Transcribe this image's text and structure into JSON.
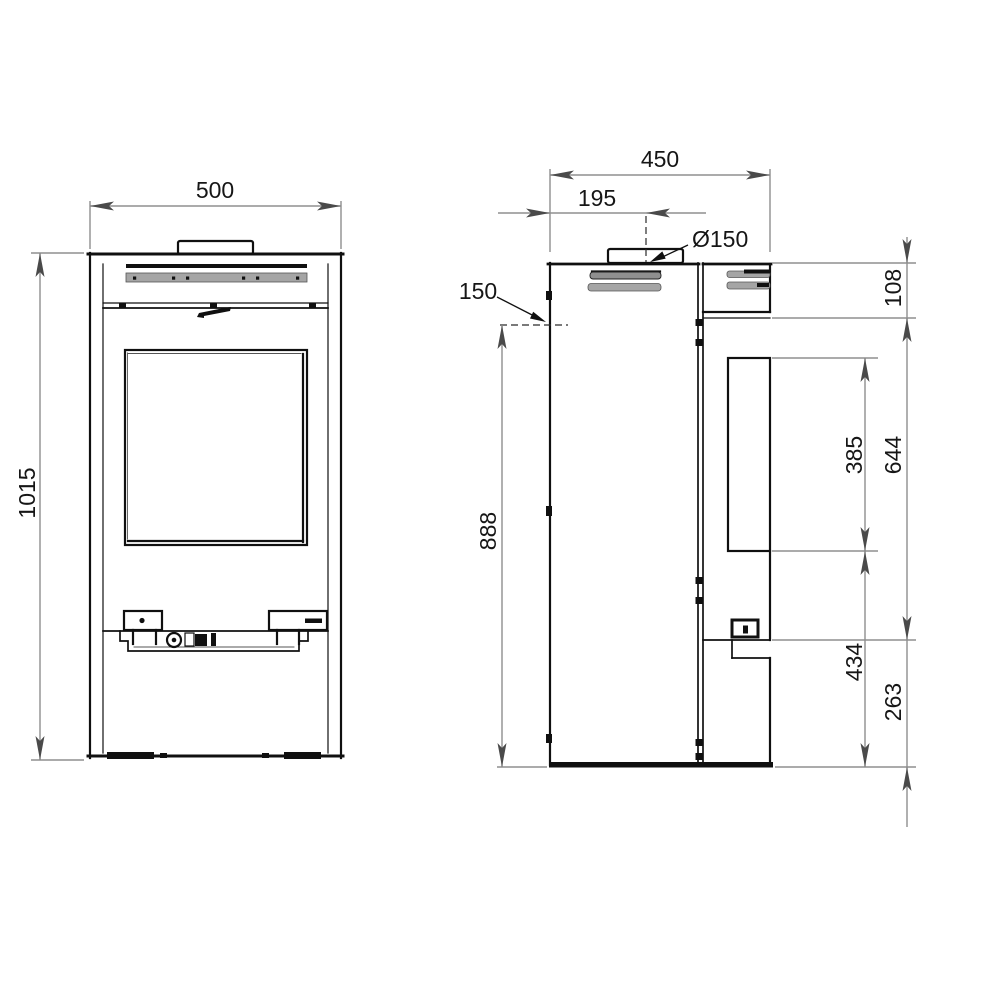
{
  "drawing": {
    "front_view": {
      "width_mm": "500",
      "height_mm": "1015"
    },
    "side_view": {
      "depth_mm": "450",
      "flue_center_from_back_mm": "195",
      "flue_diameter": "Ø150",
      "rear_flue_label": "150",
      "rear_flue_center_height_mm": "888",
      "top_section_mm": "108",
      "upper_span_mm": "644",
      "glass_height_mm": "385",
      "glass_to_floor_mm": "434",
      "lower_section_mm": "263"
    }
  }
}
